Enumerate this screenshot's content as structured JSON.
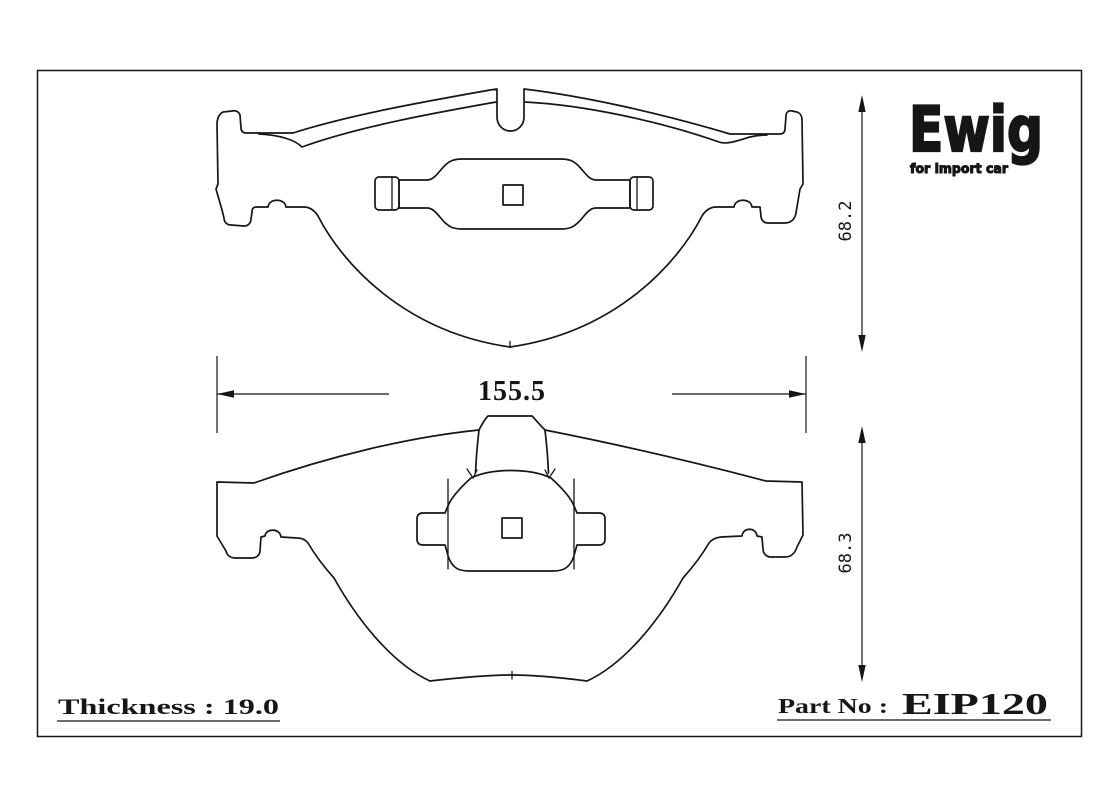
{
  "drawing": {
    "dim_width": "155.5",
    "dim_height_top": "68.2",
    "dim_height_bottom": "68.3"
  },
  "footer": {
    "thickness_text": "Thickness : 19.0",
    "part_prefix": "Part No :",
    "part_number": "EIP120"
  },
  "logo": {
    "brand": "Ewig",
    "tagline": "for import car"
  },
  "colors": {
    "line": "#161616",
    "background": "#ffffff"
  }
}
